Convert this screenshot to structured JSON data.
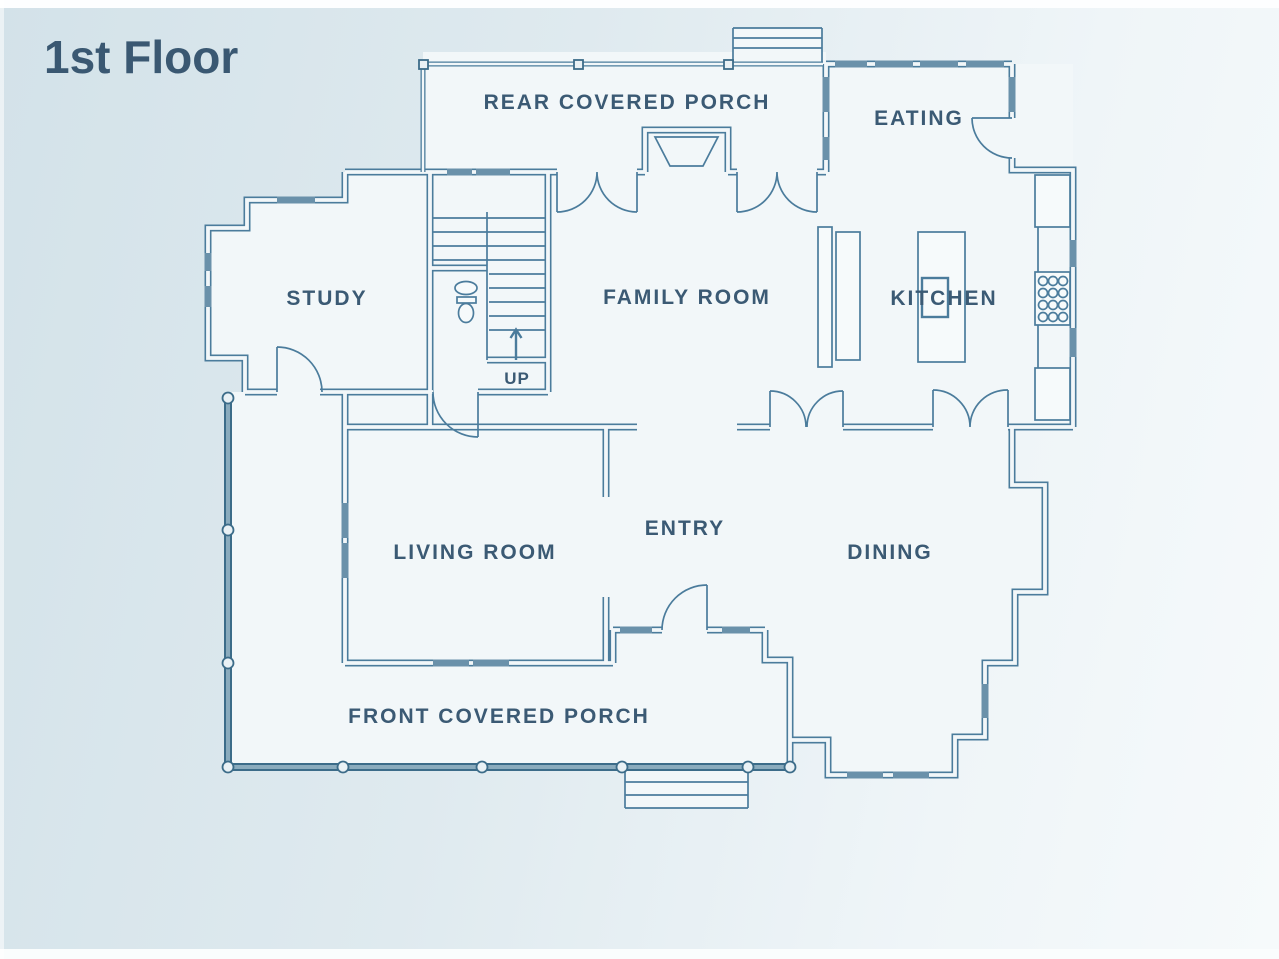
{
  "title": "1st Floor",
  "rooms": {
    "rear_porch": {
      "label": "REAR COVERED PORCH"
    },
    "eating": {
      "label": "EATING"
    },
    "study": {
      "label": "STUDY"
    },
    "family_room": {
      "label": "FAMILY ROOM"
    },
    "kitchen": {
      "label": "KITCHEN"
    },
    "entry": {
      "label": "ENTRY"
    },
    "living_room": {
      "label": "LIVING ROOM"
    },
    "dining": {
      "label": "DINING"
    },
    "front_porch": {
      "label": "FRONT COVERED PORCH"
    }
  },
  "stairs": {
    "direction_label": "UP"
  },
  "colors": {
    "background_start": "#d3e2e9",
    "background_end": "#f6fafb",
    "wall_line": "#4b7c9c",
    "window_fill": "#6a91aa",
    "rail": "#3c6c89",
    "room_fill": "#f2f7f9",
    "label_text": "#3b5a74",
    "title_text": "#3a5872"
  }
}
